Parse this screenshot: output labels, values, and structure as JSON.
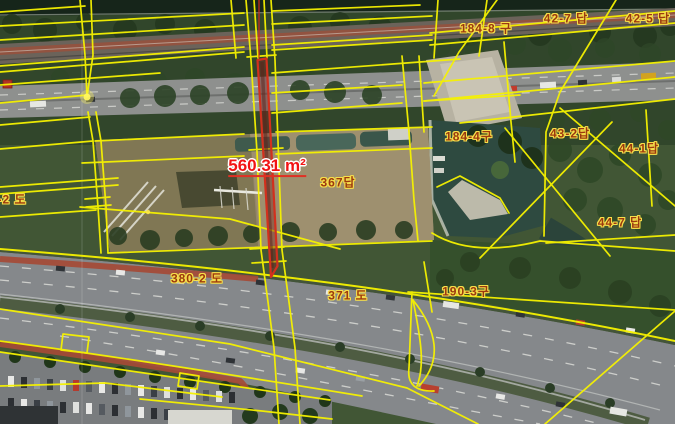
{
  "map": {
    "view": "cadastral-aerial",
    "highlight_parcel": {
      "area_label": "560.31 m²",
      "outline_color": "#d2301d",
      "label_color": "#f21414"
    },
    "parcel_labels": [
      {
        "label": "184-8 구"
      },
      {
        "label": "42-7 답"
      },
      {
        "label": "42-5 답"
      },
      {
        "label": "184-4구"
      },
      {
        "label": "43-2답"
      },
      {
        "label": "44-1답"
      },
      {
        "label": "44-7 답"
      },
      {
        "label": "367답"
      },
      {
        "label": "-2 도"
      },
      {
        "label": "380-2 도"
      },
      {
        "label": "371 도"
      },
      {
        "label": "190-3구"
      }
    ],
    "overlay_colors": {
      "parcel_line": "#f6f200",
      "parcel_label_text": "#9d3a0e"
    }
  }
}
